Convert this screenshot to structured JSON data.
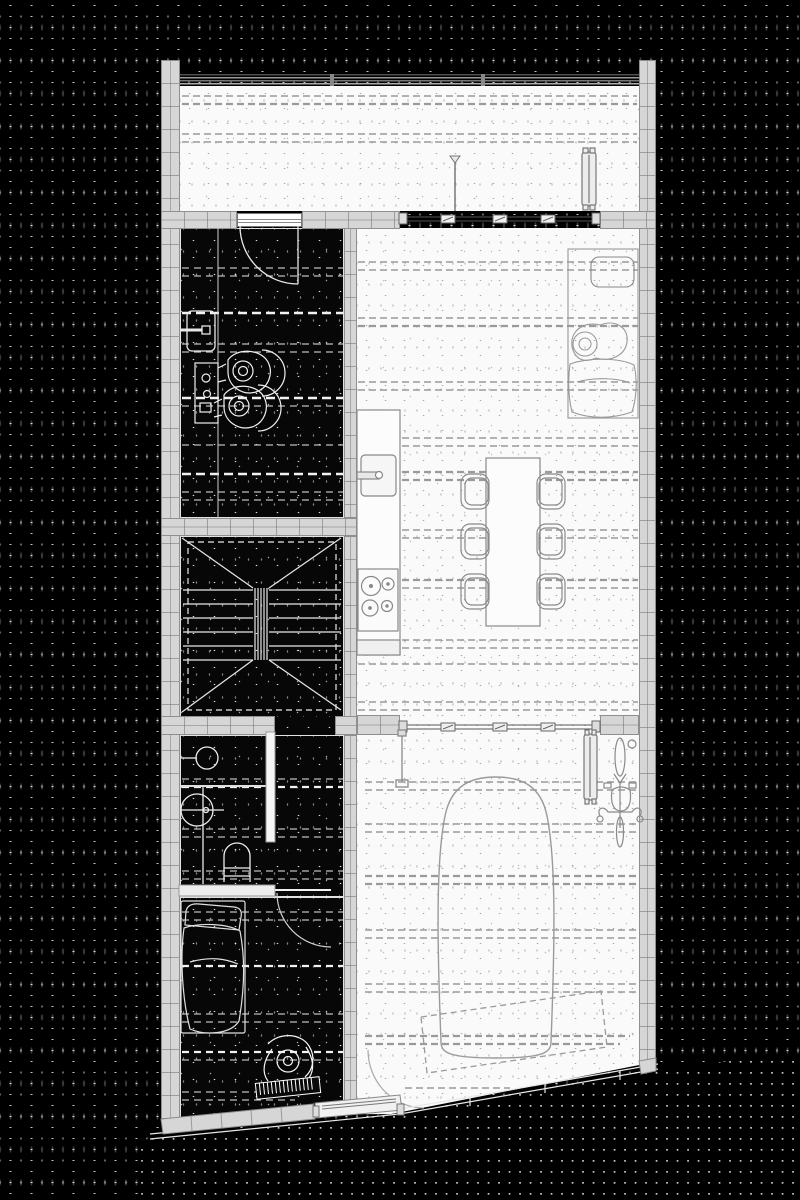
{
  "meta": {
    "title": "Black-and-white architectural floor plan on dotted black background",
    "drawing_type": "ground floor plan, top view",
    "aria_label": "Floor plan of a narrow townhouse with terrace, living-dining-kitchen space, study, stairwell, bathroom, bedroom and garage with parked car"
  },
  "palette": {
    "background": "#000000",
    "background_dot": "#c8c8c8",
    "wall_fill": "#d6d6d6",
    "wall_joint": "#8f8f8f",
    "room_dark_fill": "#070707",
    "room_light_fill": "#fafafa",
    "linework_light_rooms": "#8a8a8a",
    "linework_dark_rooms": "#f0f0f0",
    "dashed_guides": "#9a9a9a"
  },
  "rooms": [
    {
      "id": "terrace",
      "name": "Terrace / roof deck",
      "tone": "light",
      "features": [
        "guard railing",
        "radiator",
        "downpipe"
      ]
    },
    {
      "id": "study",
      "name": "Study with desk and two seated figures",
      "tone": "dark",
      "features": [
        "radiator",
        "desk",
        "two people",
        "door from terrace"
      ]
    },
    {
      "id": "stairwell",
      "name": "Stairwell with double flight stair",
      "tone": "dark",
      "features": [
        "treads",
        "flight direction diagonals",
        "central balustrade"
      ]
    },
    {
      "id": "bathroom",
      "name": "Bathroom",
      "tone": "dark",
      "features": [
        "shower",
        "round washbasin",
        "toilet",
        "door to bedroom"
      ]
    },
    {
      "id": "bedroom",
      "name": "Bedroom with single bed and piano player",
      "tone": "dark",
      "features": [
        "bed with pillow and blanket",
        "person at keyboard piano",
        "door swing"
      ]
    },
    {
      "id": "living",
      "name": "Living / dining / kitchen",
      "tone": "light",
      "features": [
        "sofa with person",
        "dining table with six chairs",
        "kitchen counter with sink and cooktop",
        "glazed wall to terrace"
      ]
    },
    {
      "id": "garage",
      "name": "Garage / carport",
      "tone": "light",
      "features": [
        "car",
        "bicycle",
        "radiator",
        "dashed door swing zone",
        "angled street facade"
      ]
    },
    {
      "id": "entry",
      "name": "Recessed entry door at angled facade",
      "tone": "light",
      "features": [
        "door leaf",
        "threshold"
      ]
    }
  ],
  "furniture": [
    "radiator",
    "desk",
    "seated-person",
    "stair-flight",
    "shower-head",
    "washbasin",
    "toilet",
    "bed",
    "piano-keyboard",
    "sofa",
    "cushion",
    "dining-table",
    "chair",
    "kitchen-sink",
    "cooktop",
    "car",
    "bicycle",
    "window-vent",
    "door-swing-arc"
  ]
}
